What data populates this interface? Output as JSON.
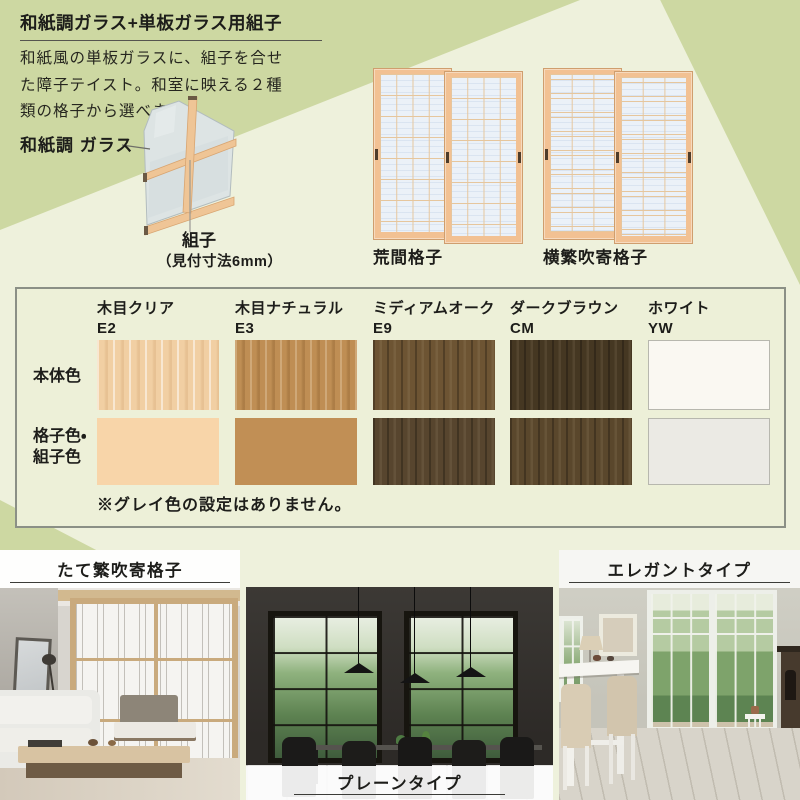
{
  "header": {
    "title": "和紙調ガラス+単板ガラス用組子",
    "description_lines": [
      "和紙風の単板ガラスに、組子を合せ",
      "た障子テイスト。和室に映える２種",
      "類の格子から選べます。"
    ]
  },
  "diagram": {
    "glass_label": "和紙調 ガラス",
    "kumiko_label": "組子",
    "kumiko_size_note": "（見付寸法6mm）"
  },
  "grille_samples": [
    {
      "label": "荒間格子"
    },
    {
      "label": "横繁吹寄格子"
    }
  ],
  "color_table": {
    "row_labels": {
      "body": "本体色",
      "grille_line1": "格子色・",
      "grille_line2": "組子色"
    },
    "columns": [
      {
        "name": "木目クリア",
        "code": "E2",
        "body_color": "#f1cfa3",
        "grille_color": "#f8d5a9"
      },
      {
        "name": "木目ナチュラル",
        "code": "E3",
        "body_color": "#bf8e54",
        "grille_color": "#c18f55"
      },
      {
        "name": "ミディアムオーク",
        "code": "E9",
        "body_color": "#6d5433",
        "grille_color": "#57452e"
      },
      {
        "name": "ダークブラウン",
        "code": "CM",
        "body_color": "#453722",
        "grille_color": "#5a472c"
      },
      {
        "name": "ホワイト",
        "code": "YW",
        "body_color": "#faf8f2",
        "grille_color": "#ebeae4"
      }
    ],
    "note": "※グレイ色の設定はありません。"
  },
  "photos": [
    {
      "label": "たて繁吹寄格子"
    },
    {
      "label": "プレーンタイプ"
    },
    {
      "label": "エレガントタイプ"
    }
  ],
  "colors": {
    "background_sage": "#cdd8a2",
    "background_cream": "#eef1dc",
    "window_wood": "#f2c193",
    "washi_glass": "#ebf1f8"
  }
}
